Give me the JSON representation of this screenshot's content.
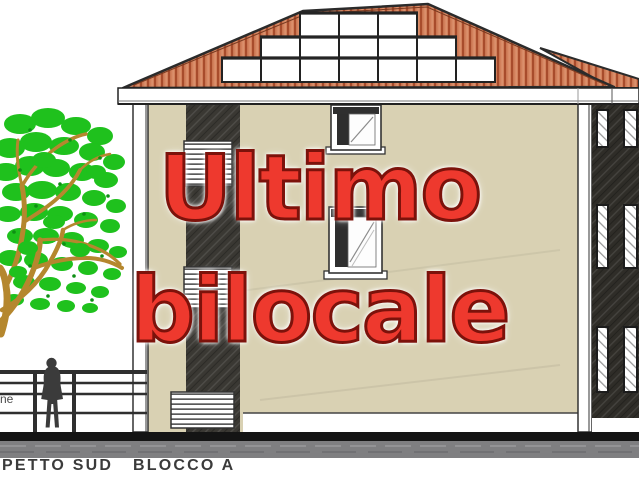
{
  "overlay_text": {
    "line1": "Ultimo",
    "line2": "bilocale",
    "fill_color": "#ee392e",
    "outline_color": "#7c120b"
  },
  "caption": "PETTO SUD   BLOCCO A",
  "edge_label": "ne",
  "drawing": {
    "type": "building-elevation",
    "skylight_rows": [
      3,
      5,
      7
    ],
    "facade_window_count": 2,
    "louver_vent_count": 3,
    "side_wall_window_rows": 3,
    "side_wall_window_cols": 2,
    "fence_rail_count": 4
  },
  "colors": {
    "roof_tile": "#d2805b",
    "roof_tile_stripe": "#a84c2c",
    "fascia": "#ffffff",
    "facade": "#d9d1b3",
    "stair_core": "#3a3833",
    "side_wall": "#2f2d28",
    "ground_band_dark": "#141414",
    "ground_band_gray": "#7f7f81",
    "tree_foliage": "#1fc11d",
    "tree_branch": "#b5872e",
    "figure": "#3b3b3b",
    "caption_text": "#3b3b3b"
  }
}
